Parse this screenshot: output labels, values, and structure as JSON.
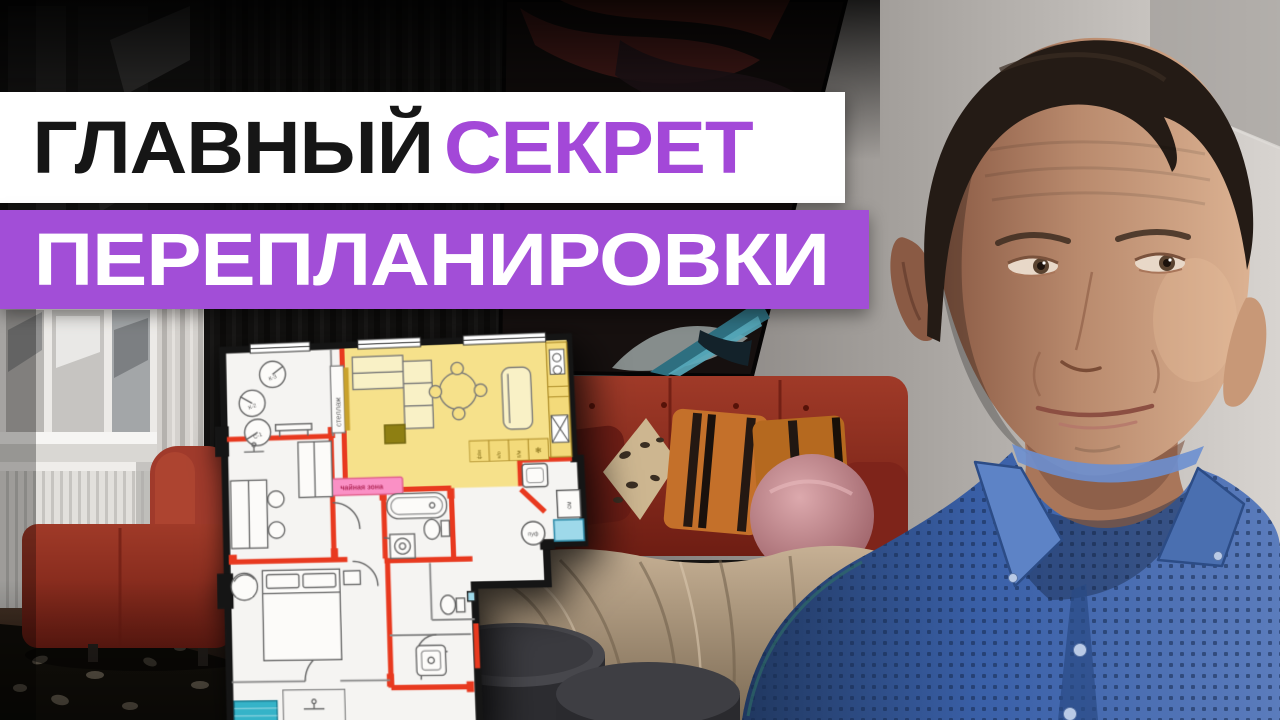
{
  "thumbnail": {
    "headline": {
      "line1_word1": "ГЛАВНЫЙ",
      "line1_word2": "СЕКРЕТ",
      "line2": "ПЕРЕПЛАНИРОВКИ"
    },
    "colors": {
      "banner_white": "#ffffff",
      "banner_purple": "#a24ed7",
      "headline_black": "#161616",
      "headline_accent_purple": "#a348d8",
      "headline_white": "#ffffff",
      "plan_highlight_yellow": "#f6df85",
      "plan_tea_zone_pink": "#fa90c5",
      "plan_new_wall_red": "#e8391f",
      "plan_window_blue": "#9ed9ea",
      "plan_doormat_teal": "#35b3c8",
      "sofa_red": "#9a3325",
      "shirt_blue": "#3a60a8"
    },
    "floor_plan": {
      "labels": {
        "shelf": "стеллаж",
        "tea_zone": "чайная зона",
        "pouf": "пуф",
        "dryer": "см",
        "seat1": "К-3",
        "seat2": "К-2",
        "seat3": "С-1",
        "appliance1": "ф/м",
        "appliance2": "н/о",
        "appliance3": "п/м",
        "fridge_icon": "❄"
      }
    }
  }
}
